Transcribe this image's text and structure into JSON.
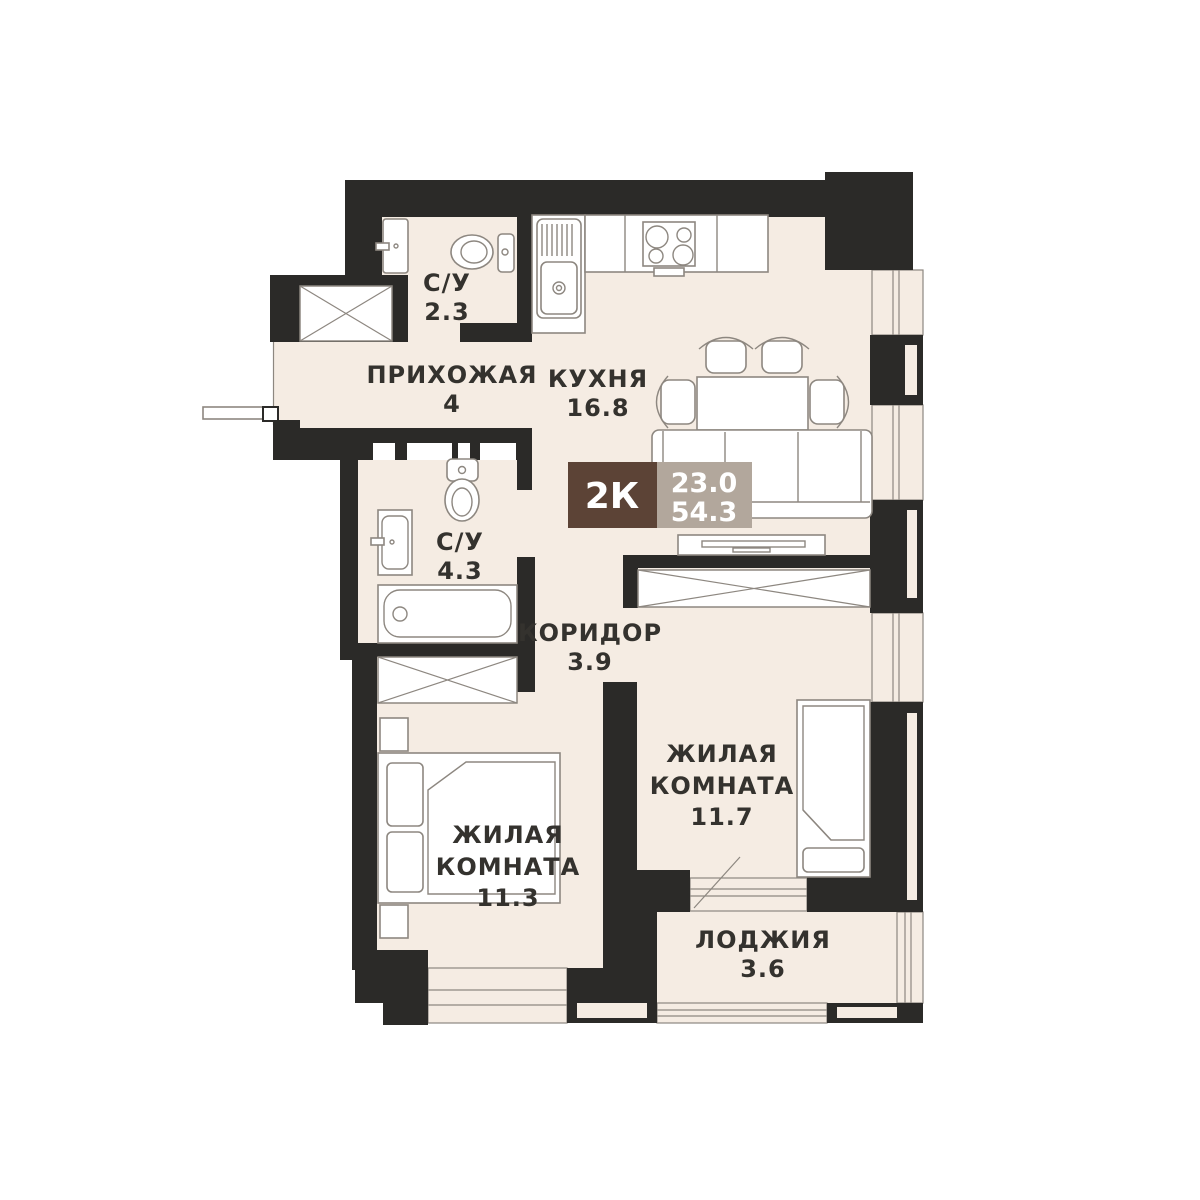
{
  "plan_title": "2K apartment floor plan",
  "badge": {
    "type_label": "2К",
    "area_living": "23.0",
    "area_total": "54.3"
  },
  "rooms": {
    "bath_top": {
      "label": "С/У",
      "area": "2.3"
    },
    "hallway": {
      "label": "ПРИХОЖАЯ",
      "area": "4"
    },
    "kitchen": {
      "label": "КУХНЯ",
      "area": "16.8"
    },
    "bath_mid": {
      "label": "С/У",
      "area": "4.3"
    },
    "corridor": {
      "label": "КОРИДОР",
      "area": "3.9"
    },
    "room_right": {
      "label1": "ЖИЛАЯ",
      "label2": "КОМНАТА",
      "area": "11.7"
    },
    "room_left": {
      "label1": "ЖИЛАЯ",
      "label2": "КОМНАТА",
      "area": "11.3"
    },
    "loggia": {
      "label": "ЛОДЖИЯ",
      "area": "3.6"
    }
  },
  "fixtures": [
    "wash-basin",
    "toilet",
    "kitchen-sink",
    "stove",
    "dining-table",
    "chairs",
    "sofa",
    "tv-console",
    "wardrobe-shaft",
    "bathtub",
    "double-bed",
    "nightstand",
    "single-bed",
    "entry-door",
    "balcony-door"
  ],
  "colors": {
    "wall": "#2b2a28",
    "floor": "#f5ece3",
    "line": "#8d8780",
    "text": "#34322e",
    "white": "#ffffff",
    "badge_brown": "#5c4336",
    "badge_taupe": "#b2a79c"
  }
}
